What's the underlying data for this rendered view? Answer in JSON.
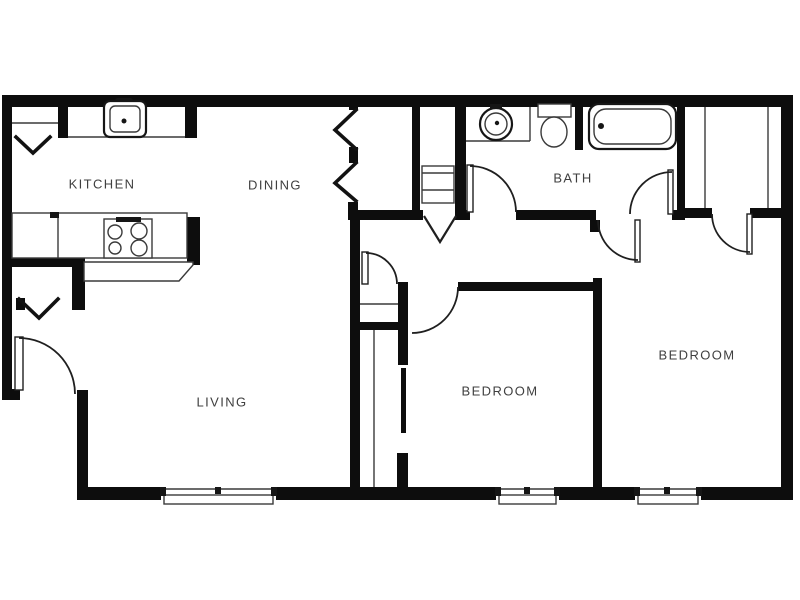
{
  "floorplan": {
    "title": "two-bedroom apartment floor plan",
    "rooms": [
      {
        "id": "kitchen",
        "label": "KITCHEN"
      },
      {
        "id": "dining",
        "label": "DINING"
      },
      {
        "id": "bath",
        "label": "BATH"
      },
      {
        "id": "living",
        "label": "LIVING"
      },
      {
        "id": "bedroom-middle",
        "label": "BEDROOM"
      },
      {
        "id": "bedroom-right",
        "label": "BEDROOM"
      }
    ],
    "fixtures": [
      "kitchen-sink",
      "stove-cooktop",
      "kitchen-counters",
      "pantry-closet",
      "coat-closet",
      "entry-door",
      "water-heater-closet",
      "bifold-doors",
      "bath-vanity-sink",
      "toilet",
      "bathtub",
      "wardrobe-closet",
      "hall-closet",
      "windows"
    ],
    "colors": {
      "wall": "#0d0d0d",
      "thin_line": "#3a3a3a",
      "label": "#3f3f3f",
      "background": "#ffffff"
    }
  }
}
